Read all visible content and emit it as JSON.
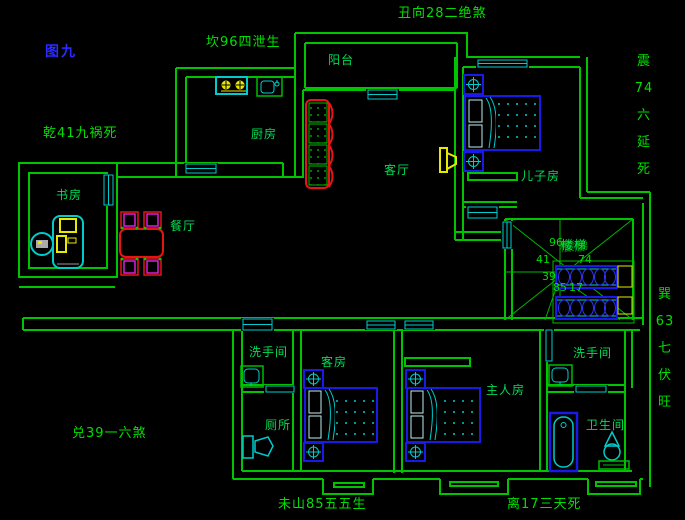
{
  "figure_label": {
    "text": "图九"
  },
  "compass_annotations": [
    {
      "name": "north",
      "text": "坎96四泄生",
      "orientation": "horizontal",
      "x": 206,
      "y": 36
    },
    {
      "name": "north-northeast",
      "text": "丑向28二绝煞",
      "orientation": "horizontal",
      "x": 398,
      "y": 7
    },
    {
      "name": "east",
      "text": "震74六延死",
      "orientation": "vertical",
      "x": 633,
      "y": 55,
      "lines": [
        "震",
        "74",
        "六",
        "延",
        "死"
      ]
    },
    {
      "name": "southeast",
      "text": "巽63七伏旺",
      "orientation": "vertical",
      "x": 654,
      "y": 288,
      "lines": [
        "巽",
        "63",
        "七",
        "伏",
        "旺"
      ]
    },
    {
      "name": "south",
      "text": "离17三天死",
      "orientation": "horizontal",
      "x": 507,
      "y": 498
    },
    {
      "name": "southwest",
      "text": "未山85五五生",
      "orientation": "horizontal",
      "x": 278,
      "y": 498
    },
    {
      "name": "west",
      "text": "兑39一六煞",
      "orientation": "horizontal",
      "x": 72,
      "y": 427
    },
    {
      "name": "northwest",
      "text": "乾41九祸死",
      "orientation": "horizontal",
      "x": 43,
      "y": 127
    }
  ],
  "room_labels": [
    {
      "name": "balcony",
      "text": "阳台",
      "x": 328,
      "y": 54
    },
    {
      "name": "kitchen",
      "text": "厨房",
      "x": 251,
      "y": 128
    },
    {
      "name": "living-room",
      "text": "客厅",
      "x": 384,
      "y": 164
    },
    {
      "name": "study",
      "text": "书房",
      "x": 56,
      "y": 189
    },
    {
      "name": "dining-room",
      "text": "餐厅",
      "x": 170,
      "y": 220
    },
    {
      "name": "sons-room",
      "text": "儿子房",
      "x": 521,
      "y": 170
    },
    {
      "name": "bathroom-left",
      "text": "洗手间",
      "x": 249,
      "y": 346
    },
    {
      "name": "toilet-room",
      "text": "厕所",
      "x": 265,
      "y": 419
    },
    {
      "name": "guest-room",
      "text": "客房",
      "x": 321,
      "y": 356
    },
    {
      "name": "master-room",
      "text": "主人房",
      "x": 486,
      "y": 384
    },
    {
      "name": "bathroom-right",
      "text": "洗手间",
      "x": 573,
      "y": 347
    },
    {
      "name": "bathroom-ensuite",
      "text": "卫生间",
      "x": 586,
      "y": 419
    },
    {
      "name": "stairs-overlapped",
      "text": "楼梯",
      "x": 561,
      "y": 239,
      "overlap": true
    }
  ],
  "stair_chart_numbers": [
    {
      "text": "96",
      "x": 549,
      "y": 237
    },
    {
      "text": "41",
      "x": 536,
      "y": 254
    },
    {
      "text": "74",
      "x": 578,
      "y": 254
    },
    {
      "text": "39",
      "x": 542,
      "y": 271
    },
    {
      "text": "85",
      "x": 553,
      "y": 282
    },
    {
      "text": "17",
      "x": 569,
      "y": 282
    }
  ],
  "colors": {
    "background": "#000000",
    "wall_green": "#00c400",
    "text_green": "#00e000",
    "window_cyan": "#00cccc",
    "furniture_blue": "#1a1ae8",
    "furniture_red": "#e81414",
    "furniture_yellow": "#e8e800",
    "accent_magenta": "#d820d8",
    "figure_blue": "#2b2bff"
  }
}
